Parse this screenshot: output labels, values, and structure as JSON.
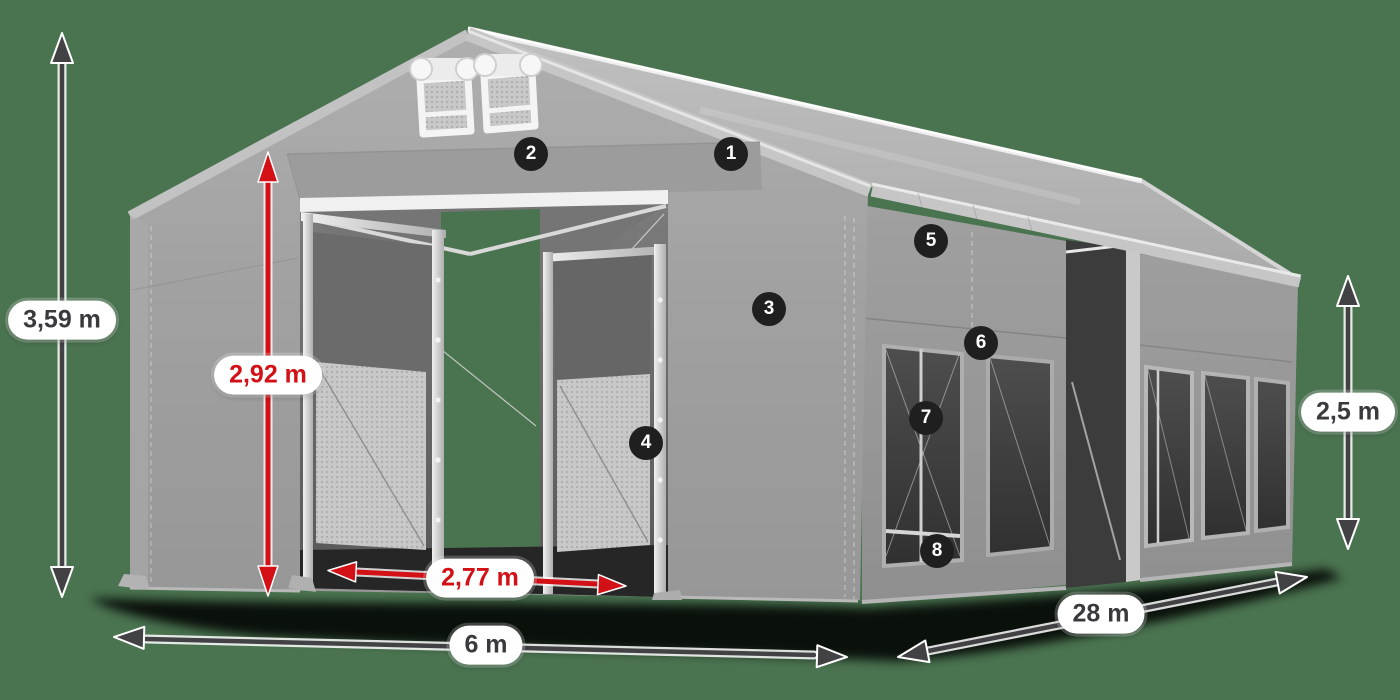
{
  "title": "Tent dimension diagram",
  "background_color": "#4A7350",
  "colors": {
    "accent_red": "#D21015",
    "arrow_dark": "#424245",
    "badge_background": "#1F1F1F",
    "badge_text": "#FFFFFF",
    "label_background": "#FFFFFF",
    "label_text_dark": "#3A3A3C",
    "tent_fabric_light": "#A8A8A8",
    "tent_fabric_medium": "#969696",
    "tent_interior_dark": "#5E5E5E"
  },
  "dimensions": {
    "total_height": {
      "text": "3,59 m",
      "style": "dark",
      "orientation": "vertical"
    },
    "entrance_height": {
      "text": "2,92 m",
      "style": "red",
      "orientation": "vertical"
    },
    "entrance_width": {
      "text": "2,77 m",
      "style": "red",
      "orientation": "horizontal"
    },
    "front_width": {
      "text": "6 m",
      "style": "dark",
      "orientation": "horizontal"
    },
    "side_length": {
      "text": "28 m",
      "style": "dark",
      "orientation": "diagonal"
    },
    "side_wall_height": {
      "text": "2,5 m",
      "style": "dark",
      "orientation": "vertical"
    }
  },
  "callouts": [
    {
      "number": "1"
    },
    {
      "number": "2"
    },
    {
      "number": "3"
    },
    {
      "number": "4"
    },
    {
      "number": "5"
    },
    {
      "number": "6"
    },
    {
      "number": "7"
    },
    {
      "number": "8"
    }
  ]
}
